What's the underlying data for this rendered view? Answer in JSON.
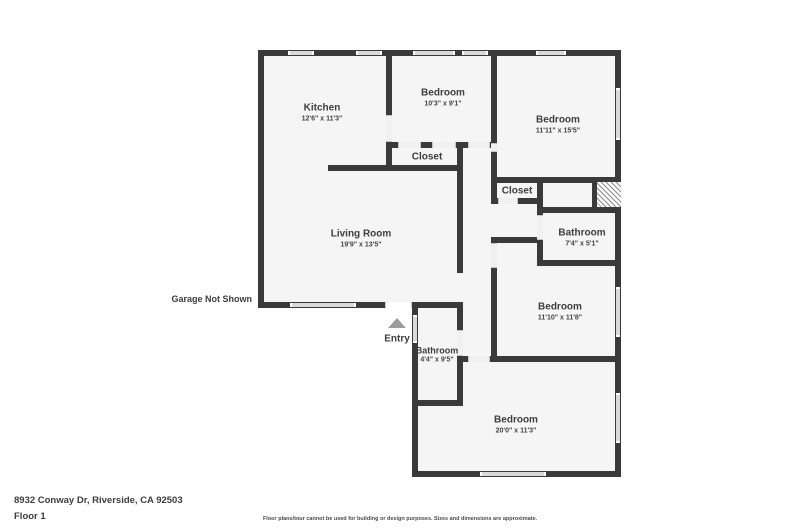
{
  "plan": {
    "rooms": [
      {
        "name": "Kitchen",
        "dims": "12'6\" x 11'3\""
      },
      {
        "name": "Bedroom",
        "dims": "10'3\" x 9'1\""
      },
      {
        "name": "Bedroom",
        "dims": "11'11\" x 15'5\""
      },
      {
        "name": "Closet"
      },
      {
        "name": "Closet"
      },
      {
        "name": "Bathroom",
        "dims": "7'4\" x 5'1\""
      },
      {
        "name": "Living Room",
        "dims": "19'9\" x 13'5\""
      },
      {
        "name": "Bedroom",
        "dims": "11'10\" x 11'8\""
      },
      {
        "name": "Bathroom",
        "dims": "4'4\" x 9'5\""
      },
      {
        "name": "Bedroom",
        "dims": "20'0\" x 11'3\""
      }
    ],
    "entry_label": "Entry",
    "garage_note": "Garage Not Shown"
  },
  "footer": {
    "address": "8932 Conway Dr, Riverside, CA 92503",
    "floor_label": "Floor 1",
    "disclaimer": "Floor plans/tour cannot be used for building or design purposes. Sizes and dimensions are approximate."
  },
  "colors": {
    "wall": "#3a3a3a",
    "floor": "#f5f5f5",
    "window": "#d9d9d9",
    "hatch_stripe": "#8a8a8a",
    "entry_arrow": "#9c9c9c",
    "text": "#3d3d3d"
  }
}
